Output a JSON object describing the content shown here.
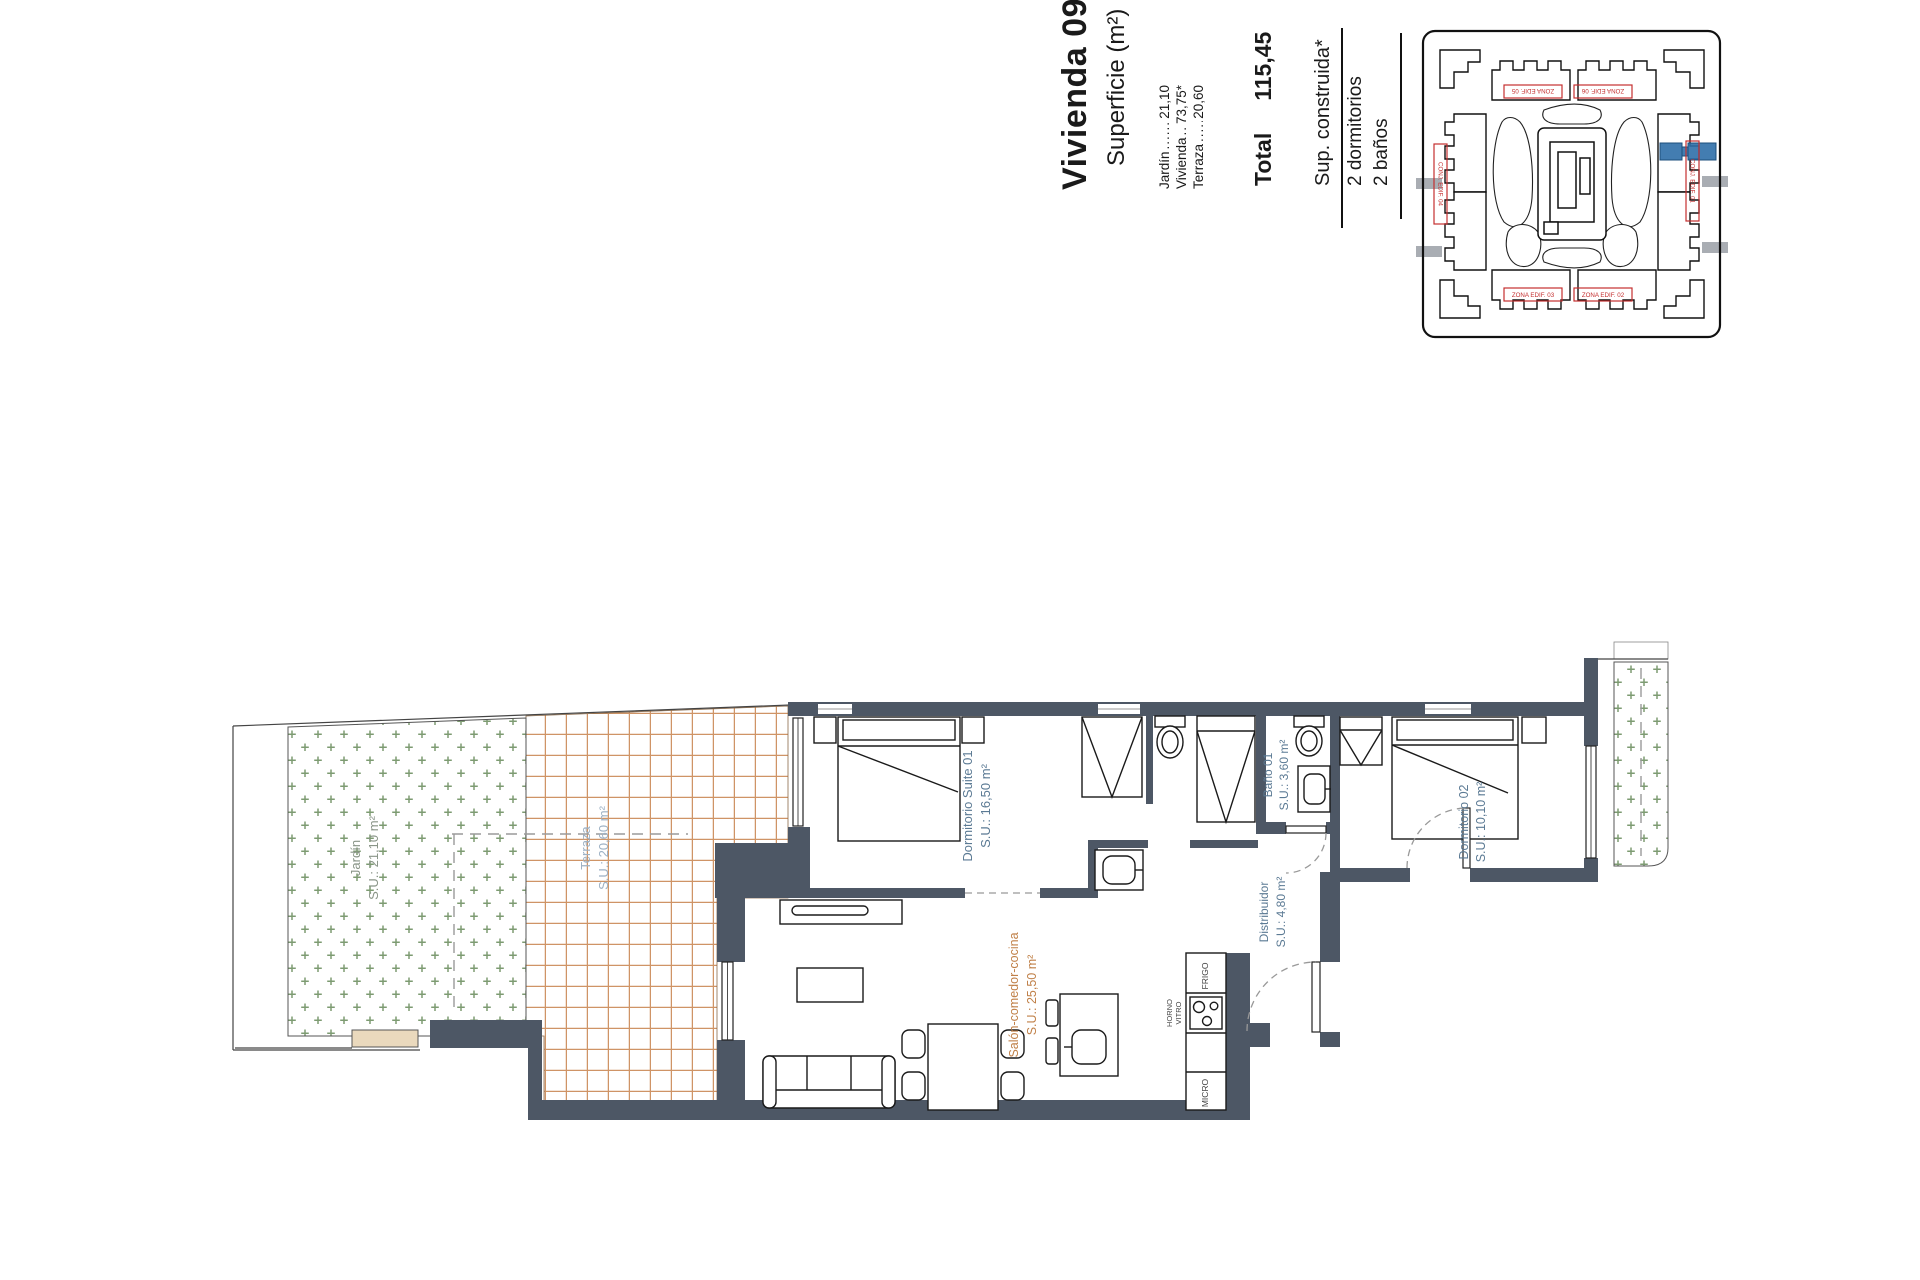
{
  "header": {
    "title": "Vivienda 09",
    "subtitle": "Superficie (m²)",
    "rows": [
      {
        "label": "Jardín",
        "leader": "...............",
        "value": "21,10"
      },
      {
        "label": "Vivienda",
        "leader": "............",
        "value": "73,75*"
      },
      {
        "label": "Terraza",
        "leader": "..............",
        "value": "20,60"
      }
    ],
    "total_label": "Total",
    "total_value": "115,45",
    "footnote": "Sup. construida*",
    "bedrooms": "2 dormitorios",
    "bathrooms": "2 baños"
  },
  "site_plan": {
    "labels": {
      "top_left": "ZONA EDIF. 05",
      "top_right": "ZONA EDIF. 06",
      "left": "CONJ. EDIF. 04",
      "right": "CONJ. EDIF. 01",
      "bottom_left": "ZONA EDIF. 03",
      "bottom_right": "ZONA EDIF. 02"
    }
  },
  "floor_plan": {
    "rooms": {
      "jardin": {
        "name": "Jardín",
        "area": "S.U.: 21,10 m²"
      },
      "terraza": {
        "name": "Terraza",
        "area": "S.U.: 20,60 m²"
      },
      "salon": {
        "name": "Salón-comedor-cocina",
        "area": "S.U.: 25,50 m²"
      },
      "suite": {
        "name": "Dormitorio Suite 01",
        "area": "S.U.: 16,50 m²"
      },
      "bano1": {
        "name": "Baño 01",
        "area": "S.U.: 3,60 m²"
      },
      "distribuidor": {
        "name": "Distribuidor",
        "area": "S.U.: 4,80 m²"
      },
      "dorm2": {
        "name": "Dormitorio 02",
        "area": "S.U.: 10,10 m²"
      }
    },
    "appliances": {
      "fridge": "FRIGO",
      "oven": "HORNO",
      "hob": "VITRO",
      "micro": "MICRO"
    }
  },
  "colors": {
    "wall": "#4d5765",
    "tile_line": "#cf9466",
    "garden_green": "#7d9b72",
    "label_blue": "#5b7a94",
    "label_light_blue": "#9db1c4",
    "label_orange": "#c08048",
    "label_green_gray": "#8a9588",
    "red": "#c42f2f",
    "highlight_blue": "#2f6fa8"
  }
}
